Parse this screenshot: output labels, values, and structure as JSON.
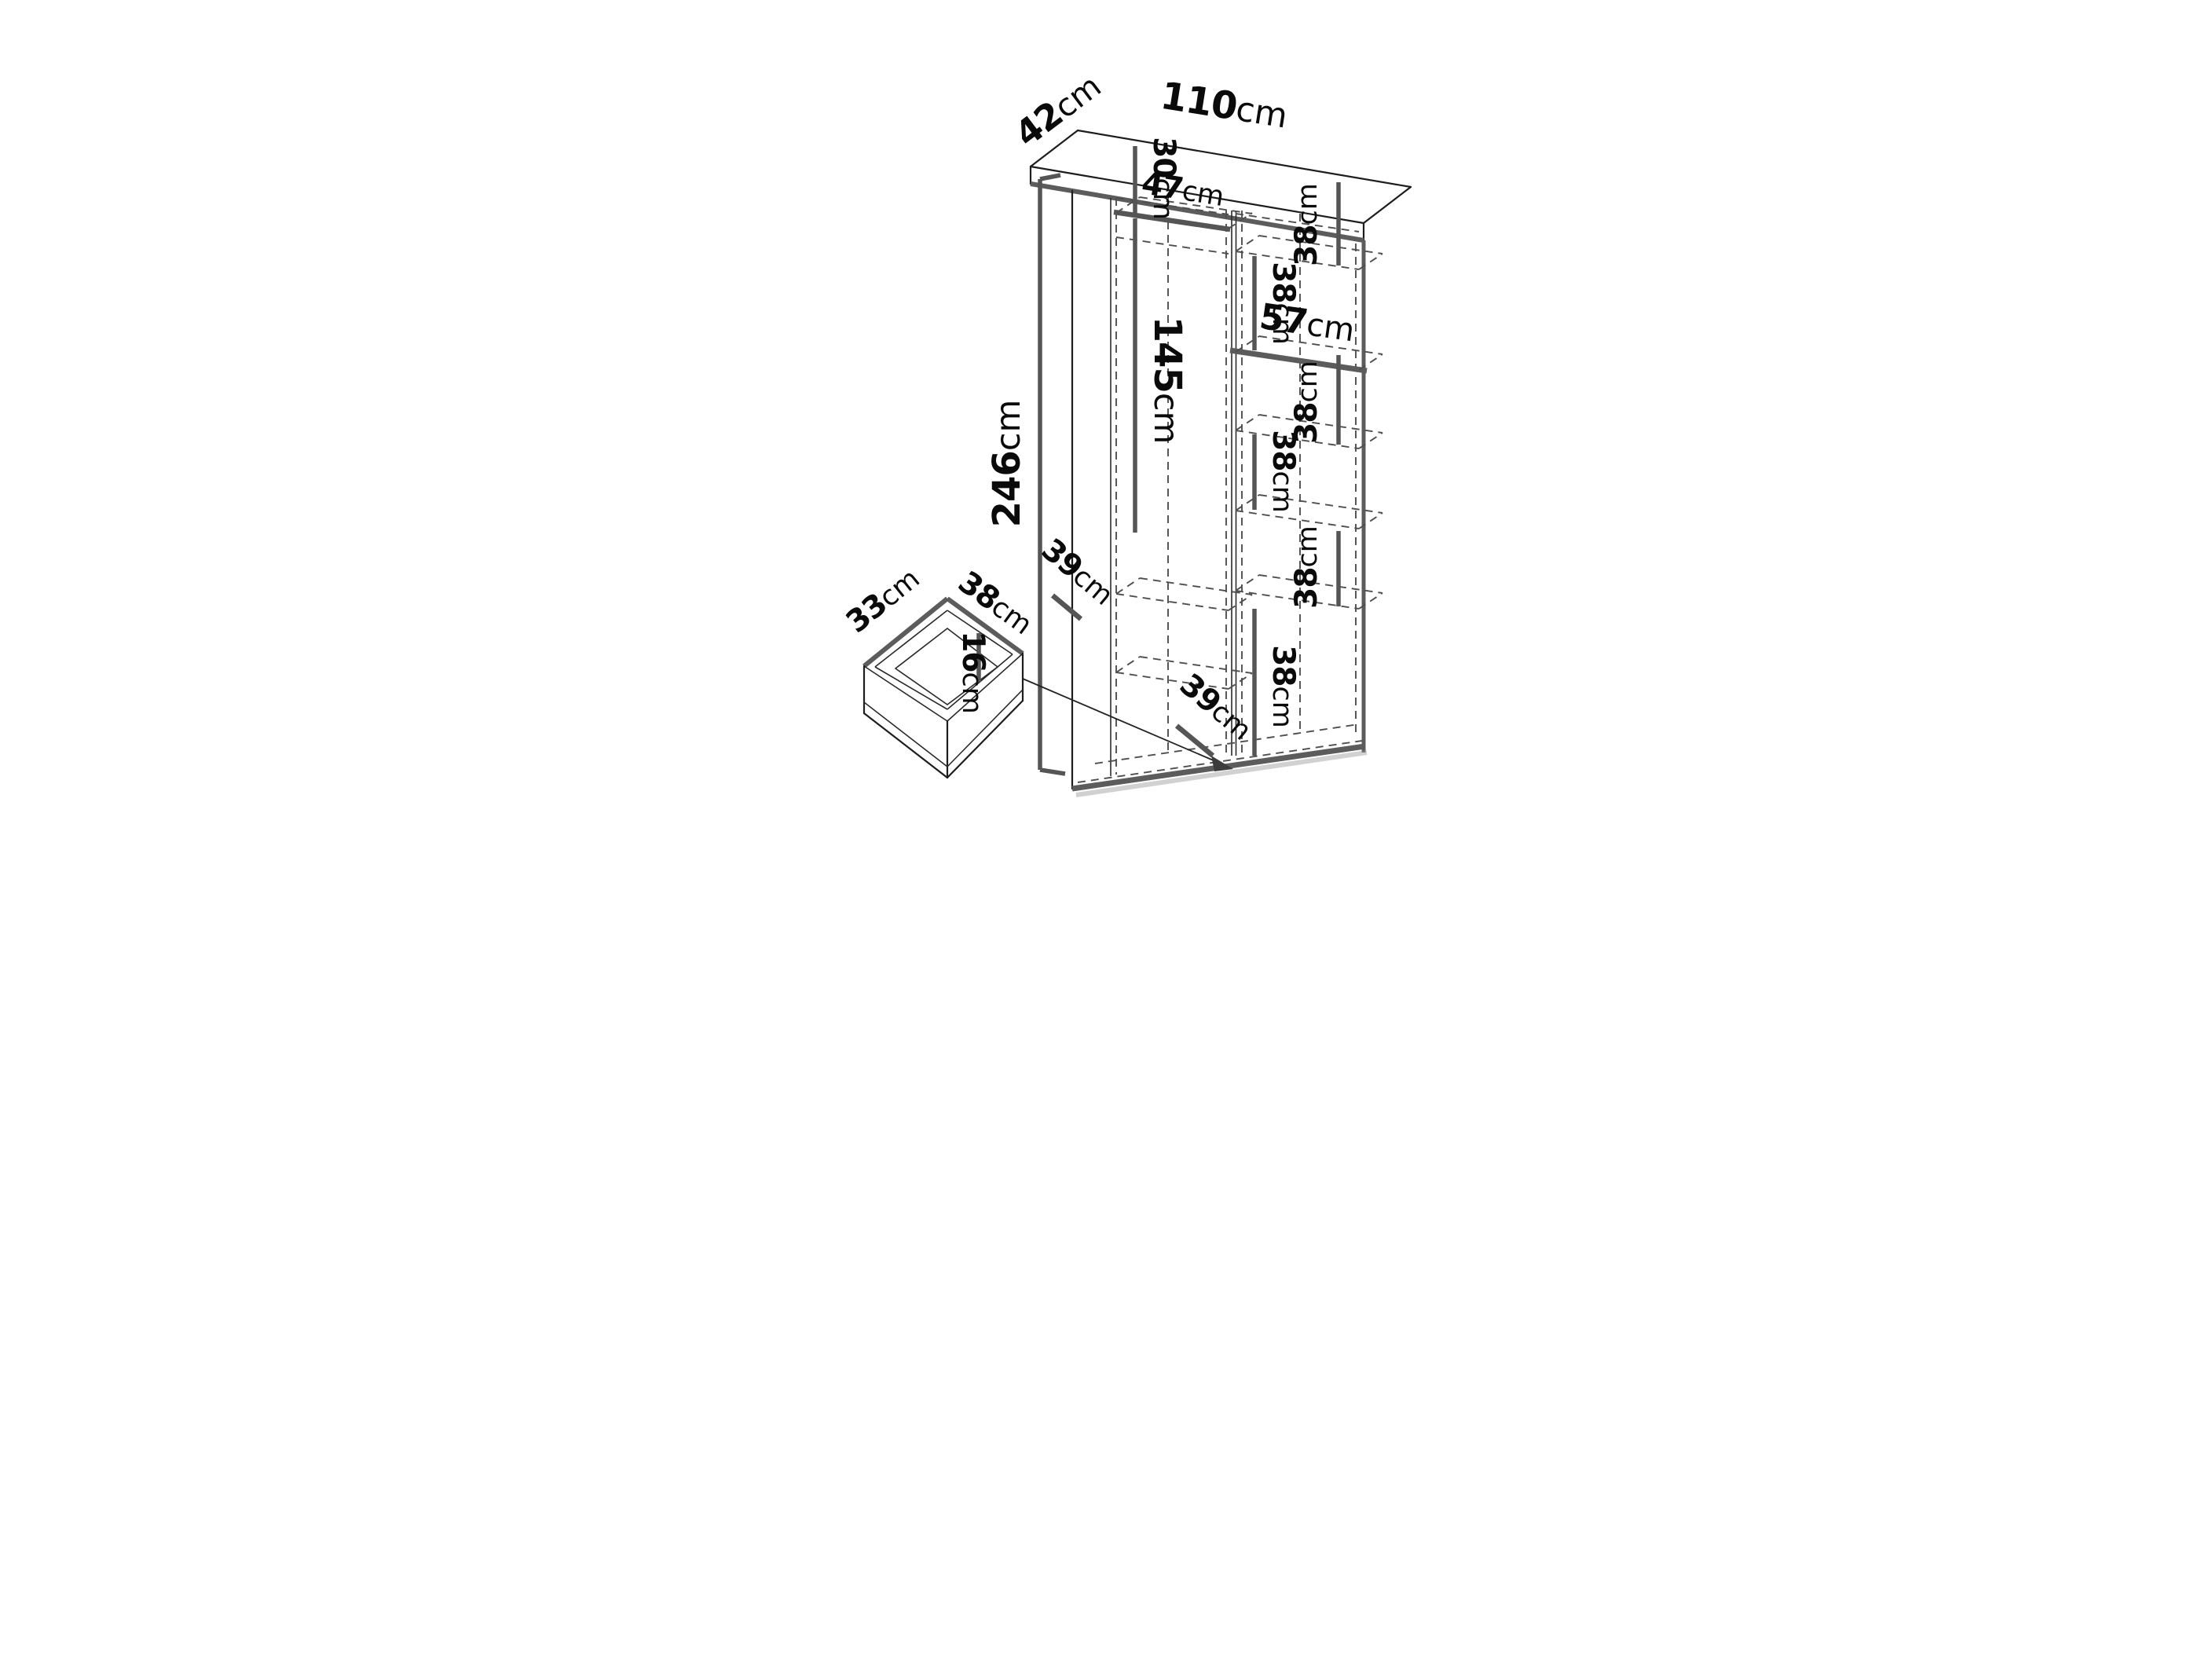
{
  "diagram": {
    "kind": "furniture-dimension-diagram",
    "subject": "tall wardrobe interior with shelf column and pull-out drawer detail",
    "unit": "cm",
    "line_color": "#1d1d1d",
    "dimension_bar_color": "#555555",
    "background": "#ffffff"
  },
  "wardrobe": {
    "overall_height_cm": "246",
    "overall_width_cm": "110",
    "overall_depth_cm": "42",
    "left_column": {
      "top_compartment_height_cm": "30",
      "shelf_width_cm": "47",
      "hanging_space_height_cm": "145",
      "bottom_shelf_depth_cm": "39"
    },
    "right_column": {
      "shelf_width_cm": "57",
      "compartment_heights_cm": [
        "38",
        "38",
        "38",
        "38",
        "38",
        "38"
      ],
      "bottom_depth_cm": "39"
    }
  },
  "drawer": {
    "width_cm": "33",
    "depth_cm": "38",
    "height_cm": "16"
  },
  "labels": {
    "l42": {
      "num": "42",
      "unit": "cm"
    },
    "l110": {
      "num": "110",
      "unit": "cm"
    },
    "l30": {
      "num": "30",
      "unit": "cm"
    },
    "l47": {
      "num": "47",
      "unit": "cm"
    },
    "r38_1": {
      "num": "38",
      "unit": "cm"
    },
    "r38_2": {
      "num": "38",
      "unit": "cm"
    },
    "l57": {
      "num": "57",
      "unit": "cm"
    },
    "r38_3": {
      "num": "38",
      "unit": "cm"
    },
    "l145": {
      "num": "145",
      "unit": "cm"
    },
    "r38_4": {
      "num": "38",
      "unit": "cm"
    },
    "r38_5": {
      "num": "38",
      "unit": "cm"
    },
    "l246": {
      "num": "246",
      "unit": "cm"
    },
    "l39_left": {
      "num": "39",
      "unit": "cm"
    },
    "r38_6": {
      "num": "38",
      "unit": "cm"
    },
    "l39_right": {
      "num": "39",
      "unit": "cm"
    },
    "d33": {
      "num": "33",
      "unit": "cm"
    },
    "d38": {
      "num": "38",
      "unit": "cm"
    },
    "d16": {
      "num": "16",
      "unit": "cm"
    }
  }
}
